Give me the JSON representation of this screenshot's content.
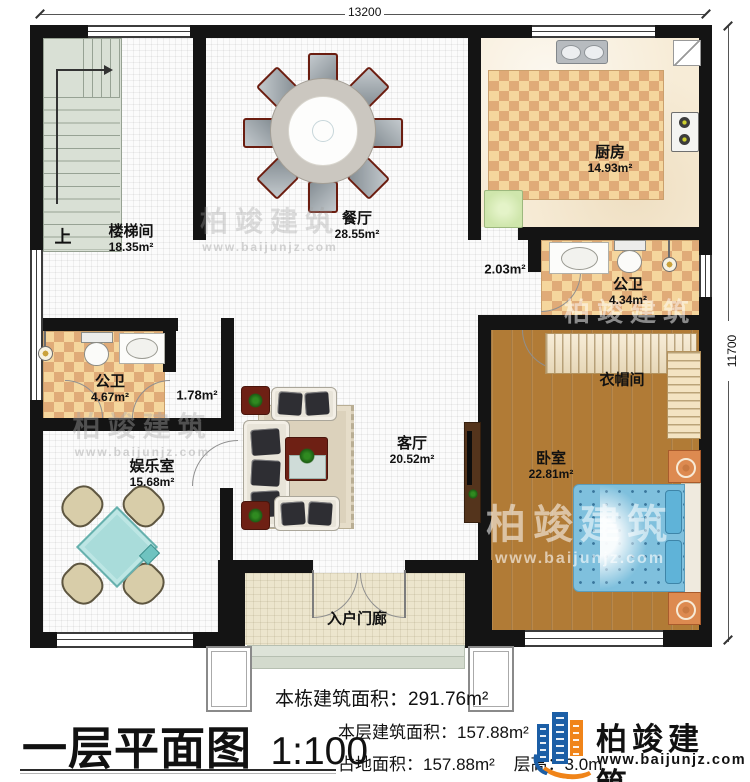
{
  "plan": {
    "title": "一层平面图",
    "scale": "1:100",
    "dimensions": {
      "top": "13200",
      "right": "11700"
    },
    "rooms": {
      "stairwell": {
        "name": "楼梯间",
        "area": "18.35m²"
      },
      "up_label": "上",
      "dining": {
        "name": "餐厅",
        "area": "28.55m²"
      },
      "kitchen": {
        "name": "厨房",
        "area": "14.93m²"
      },
      "bath_top": {
        "name": "公卫",
        "area": "4.34m²"
      },
      "corridor_area": "2.03m²",
      "cloakroom": {
        "name": "衣帽间"
      },
      "bedroom": {
        "name": "卧室",
        "area": "22.81m²"
      },
      "bath_left": {
        "name": "公卫",
        "area": "4.67m²"
      },
      "passage_area": "1.78m²",
      "entertainment": {
        "name": "娱乐室",
        "area": "15.68m²"
      },
      "living": {
        "name": "客厅",
        "area": "20.52m²"
      },
      "porch": {
        "name": "入户门廊"
      }
    },
    "stats": {
      "building_total": "本栋建筑面积：291.76m²",
      "floor_area": "本层建筑面积：157.88m²",
      "land_area": "占地面积：157.88m²",
      "floor_height": "层高：3.0m"
    },
    "brand": {
      "name": "柏竣建筑",
      "url": "www.baijunjz.com"
    },
    "watermark": {
      "text": "柏竣建筑",
      "url": "www.baijunjz.com"
    },
    "colors": {
      "brand_blue": "#1b5ea6",
      "brand_orange": "#f08419",
      "wall": "#141414"
    }
  }
}
